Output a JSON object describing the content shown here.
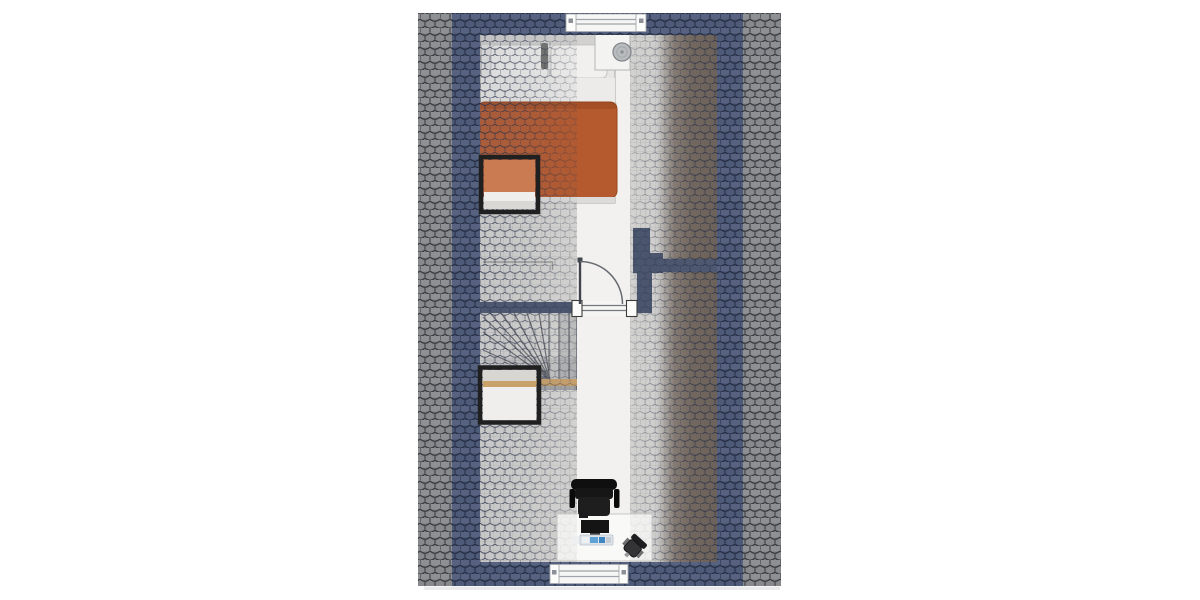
{
  "meta": {
    "type": "floor-plan",
    "view": "top-down",
    "visible_text": ""
  },
  "colors": {
    "background": "#ffffff",
    "tile_gray": "#87898d",
    "tile_gray_line": "#3a3d43",
    "tile_blue": "#4d5a78",
    "tile_blue_line": "#272f46",
    "overlay_tile_line": "#2b3248",
    "wall": "#49546d",
    "floor": "#d8d7d4",
    "floor_grid_line": "#8a8a86",
    "hall_strip": "#f3f2f0",
    "brown_band": "#6e6053",
    "wood_rail": "#c9a26b",
    "duvet": "#b5592e",
    "duvet_edge": "#99471f",
    "pillow": "#f1f0ee",
    "sheet": "#ecebe9",
    "bed_frame": "#e7e6e4",
    "headboard": "#d2d1cf",
    "skylight_frame": "#202020",
    "skylight_orange": "#cb7b52",
    "window_frame": "#f6f6f5",
    "window_glass_line": "#9fa4ab",
    "door_frame": "#f5f5f4",
    "door_leaf": "#41454b",
    "door_swing_line": "#666a70",
    "stair_tread_line": "#595b60",
    "chair_black": "#161616",
    "monitor_black": "#141414",
    "keyboard": "#dfe4ea",
    "keyboard_accent": "#5fa3d6",
    "nightstand": "#f3f3f1",
    "basin_gray": "#b9bcbf",
    "shadow": "#e8e8e7"
  },
  "objects": {
    "bedroom": [
      "double-bed",
      "pillows",
      "duvet",
      "headboard",
      "nightstand",
      "round-basin",
      "roof-window"
    ],
    "landing": [
      "interior-door",
      "door-swing-arc",
      "winder-staircase",
      "roof-window",
      "wood-handrail"
    ],
    "study_area": [
      "desk",
      "office-chair",
      "monitor",
      "keyboard",
      "smartphone",
      "small-chair",
      "rear-window"
    ],
    "envelope": [
      "gray-roof-tiles",
      "blue-roof-tiles",
      "brown-wood-band",
      "front-window",
      "gable-walls"
    ]
  }
}
